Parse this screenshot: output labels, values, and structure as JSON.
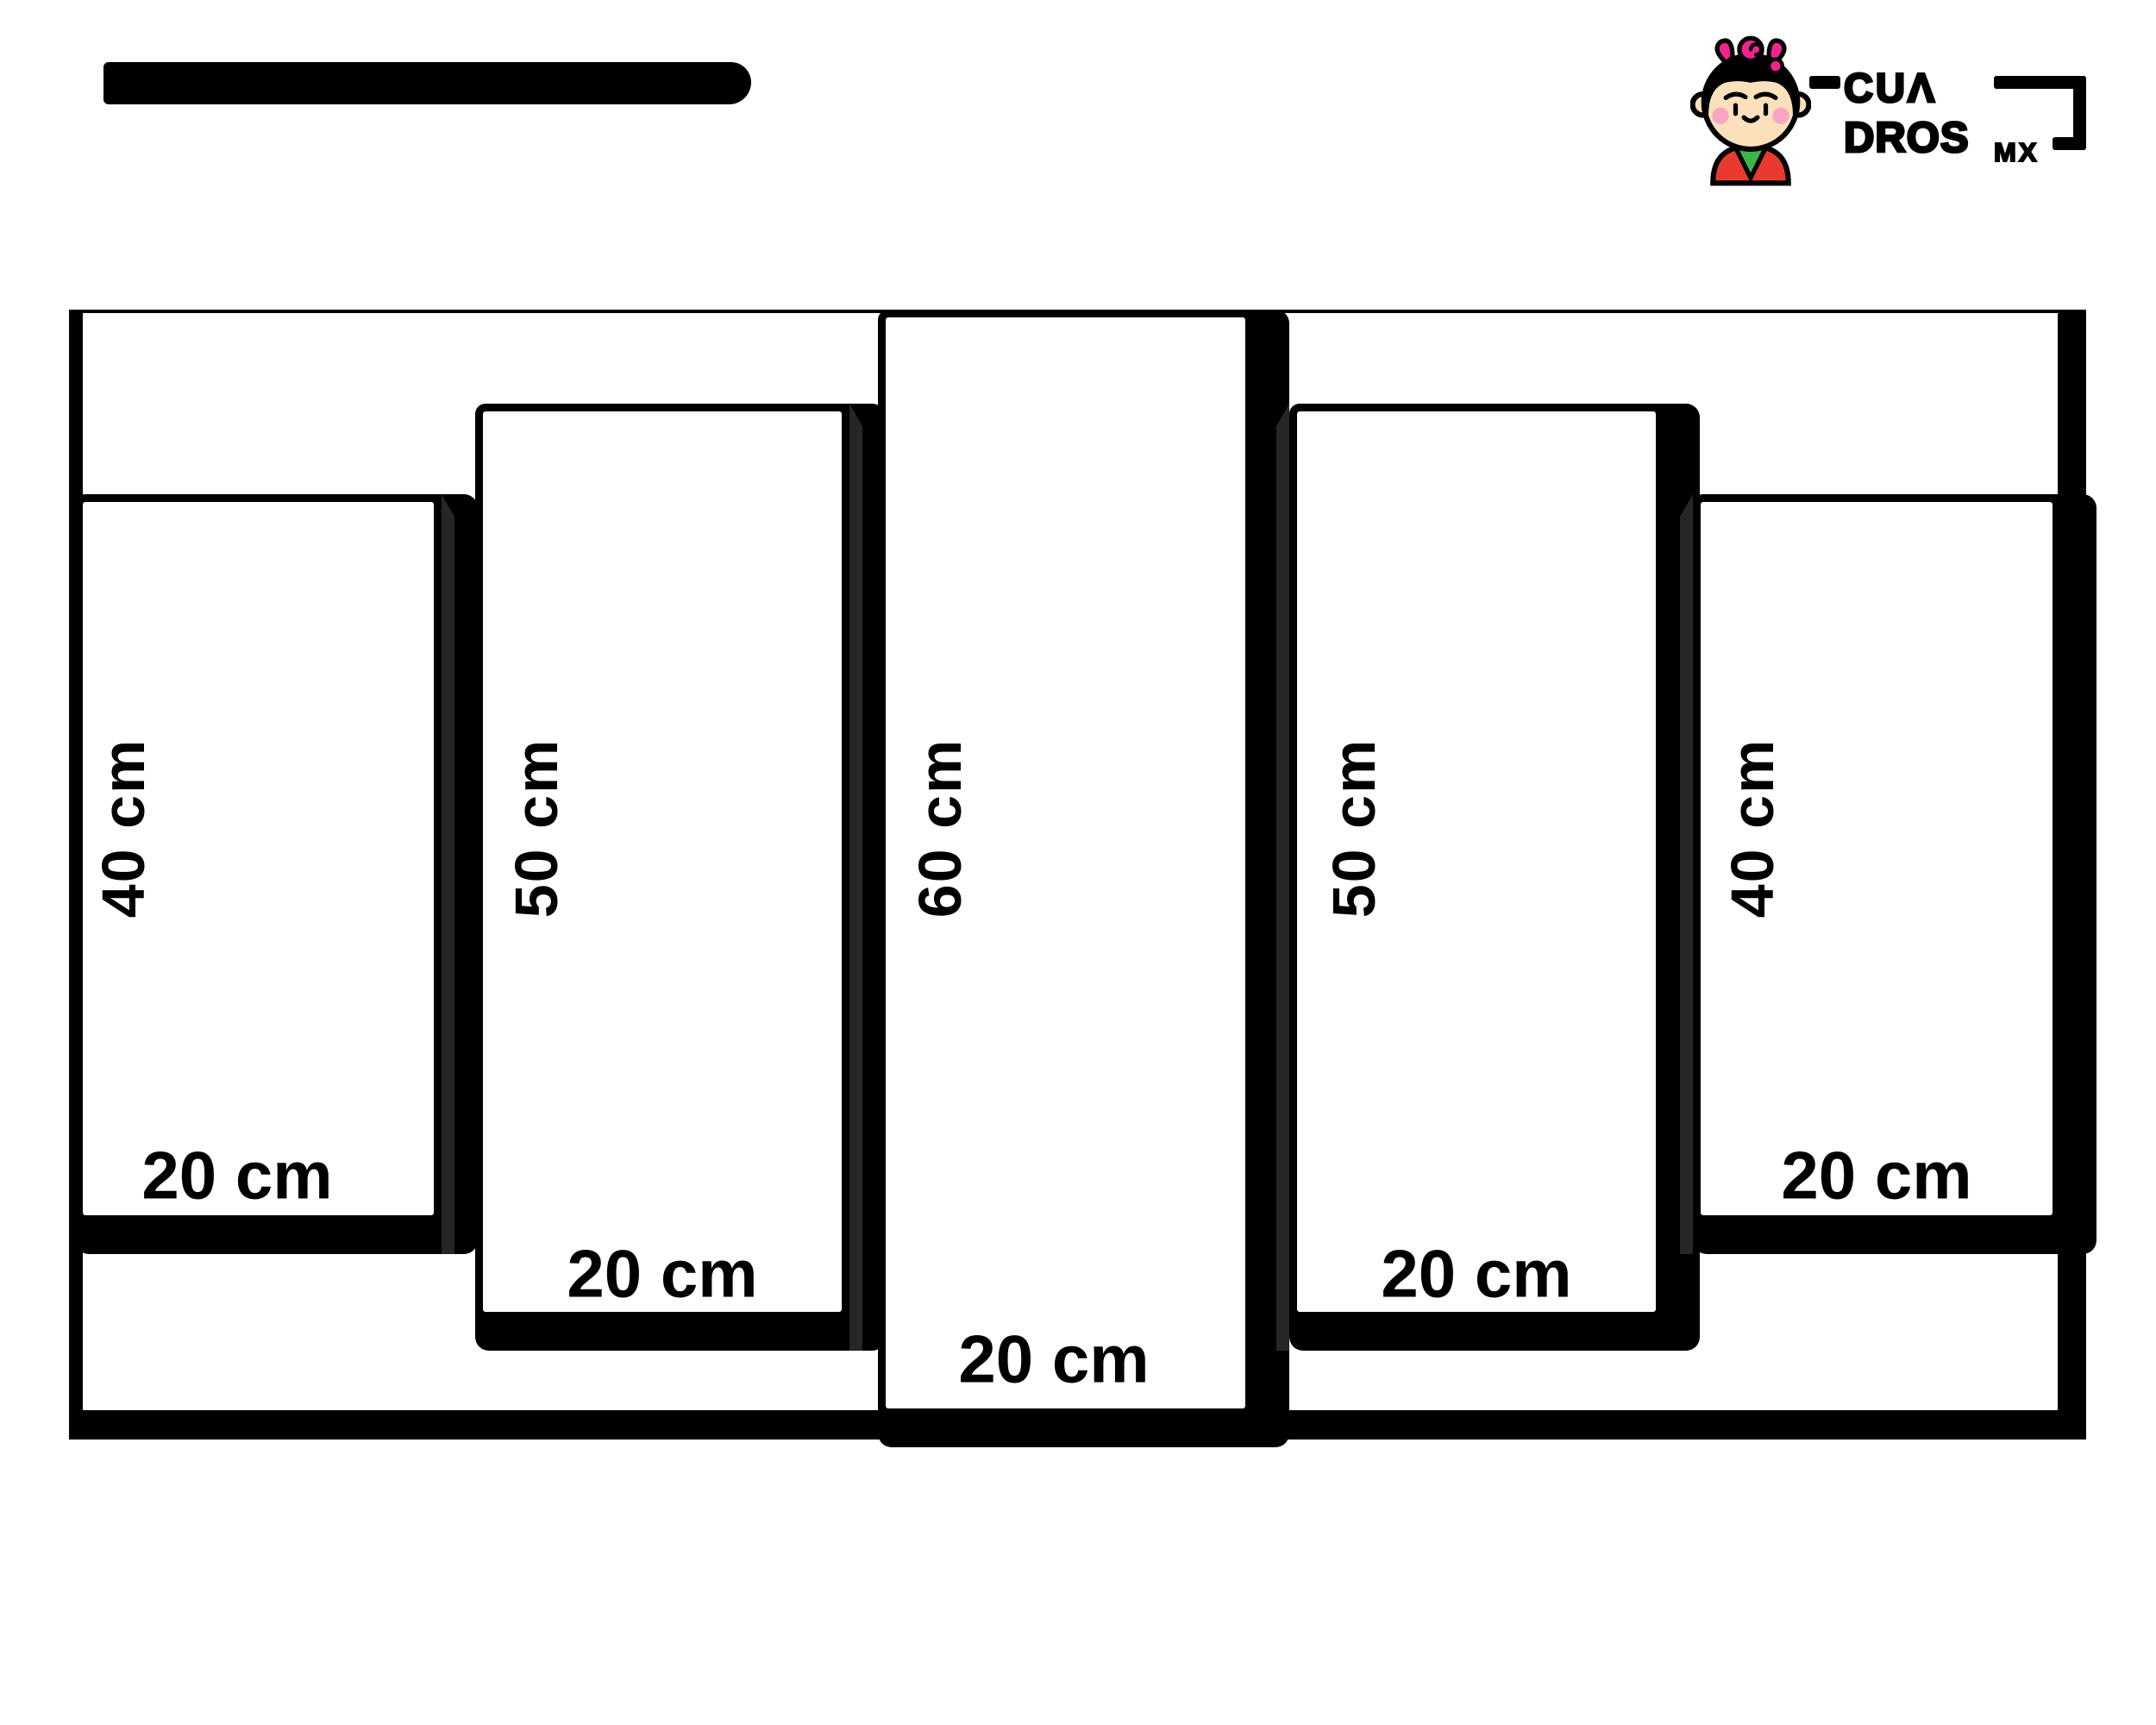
{
  "brand": {
    "full_name": "CUADROSMX",
    "line1": "CUΛ",
    "line2": "DROS",
    "suffix": "MX"
  },
  "panels": [
    {
      "position": 1,
      "height_label": "40 cm",
      "width_label": "20 cm"
    },
    {
      "position": 2,
      "height_label": "50 cm",
      "width_label": "20 cm"
    },
    {
      "position": 3,
      "height_label": "60 cm",
      "width_label": "20 cm"
    },
    {
      "position": 4,
      "height_label": "50 cm",
      "width_label": "20 cm"
    },
    {
      "position": 5,
      "height_label": "40 cm",
      "width_label": "20 cm"
    }
  ],
  "colors": {
    "outline_black": "#000000",
    "shadow_side_gray": "#262626",
    "logo_pink": "#F0248C",
    "logo_skin": "#FBE0BC",
    "logo_blush": "#F6A8C2",
    "logo_red": "#E93A2F",
    "logo_green": "#3BB54A",
    "background": "#ffffff"
  }
}
